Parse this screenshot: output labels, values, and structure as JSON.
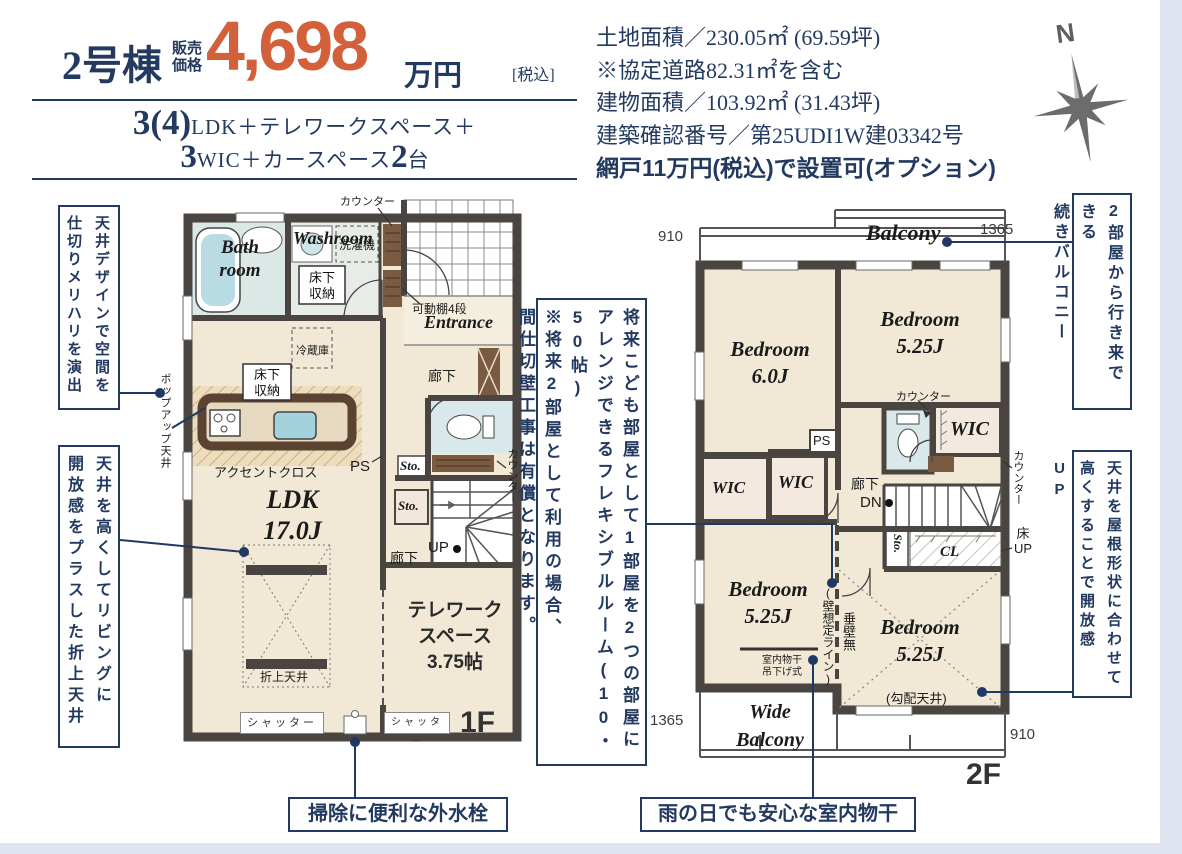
{
  "header": {
    "building": "2号棟",
    "price_label_top": "販売",
    "price_label_bottom": "価格",
    "price": "4,698",
    "price_unit": "万円",
    "tax_note": "[税込]",
    "layout_big1": "3(4)",
    "layout_rest1": "LDK＋テレワークスペース＋",
    "layout_big2": "3",
    "layout_mid2": "WIC＋カースペース",
    "layout_big3": "2",
    "layout_end2": "台"
  },
  "property_info": {
    "land_area": "土地面積／230.05㎡ (69.59坪)",
    "road_note": "※協定道路82.31㎡を含む",
    "building_area": "建物面積／103.92㎡ (31.43坪)",
    "confirmation_no": "建築確認番号／第25UDI1W建03342号",
    "screen_option": "網戸11万円(税込)で設置可(オプション)"
  },
  "compass": {
    "north_label": "N"
  },
  "plan1f": {
    "floor_label": "1F",
    "counter_top": "カウンター",
    "bathroom": "Bath\nroom",
    "washroom": "Washroom",
    "washer": "洗濯機",
    "underfloor": "床下\n収納",
    "shelf": "可動棚4段",
    "entrance": "Entrance",
    "hallway": "廊下",
    "fridge": "冷蔵庫",
    "accent_cloth": "アクセントクロス",
    "ps": "PS",
    "sto": "Sto.",
    "counter_right": "カウンター",
    "up": "UP",
    "ldk": "LDK\n17.0J",
    "oriage_ceiling": "折上天井",
    "telework": "テレワーク\nスペース\n3.75帖",
    "shutter": "シャッター",
    "popup_ceiling": "ポップアップ天井"
  },
  "plan2f": {
    "floor_label": "2F",
    "balcony": "Balcony",
    "d910": "910",
    "d1365": "1365",
    "bedroom_60": "Bedroom\n6.0J",
    "bedroom_525": "Bedroom\n5.25J",
    "counter": "カウンター",
    "wic": "WIC",
    "ps": "PS",
    "hallway": "廊下",
    "dn": "DN",
    "sto": "Sto.",
    "cl": "CL",
    "yuka_up": "床\nUP",
    "wall_line": "(壁想定ライン)",
    "no_drop_wall": "垂壁無",
    "monohoshi": "室内物干\n吊下げ式",
    "slope_ceiling": "(勾配天井)",
    "wide_balcony": "Wide\nBalcony"
  },
  "annotations": {
    "left1": [
      "天井デザインで空間を",
      "仕切りメリハリを演出"
    ],
    "left2": [
      "天井を高くしてリビングに",
      "開放感をプラスした折上天井"
    ],
    "middle": [
      "将来こども部屋として1部屋を2つの部屋に",
      "アレンジできるフレキシブルルーム(10・50帖)",
      "※将来2部屋として利用の場合、",
      "間仕切壁工事は有償となります。"
    ],
    "right1": [
      "2部屋から行き来できる",
      "続きバルコニー"
    ],
    "right2": [
      "天井を屋根形状に合わせて",
      "高くすることで開放感UP"
    ],
    "bottom1": "掃除に便利な外水栓",
    "bottom2": "雨の日でも安心な室内物干"
  },
  "colors": {
    "navy": "#233a60",
    "orange": "#d2603a",
    "wall": "#4a4541",
    "floor": "#f1e9d5"
  }
}
